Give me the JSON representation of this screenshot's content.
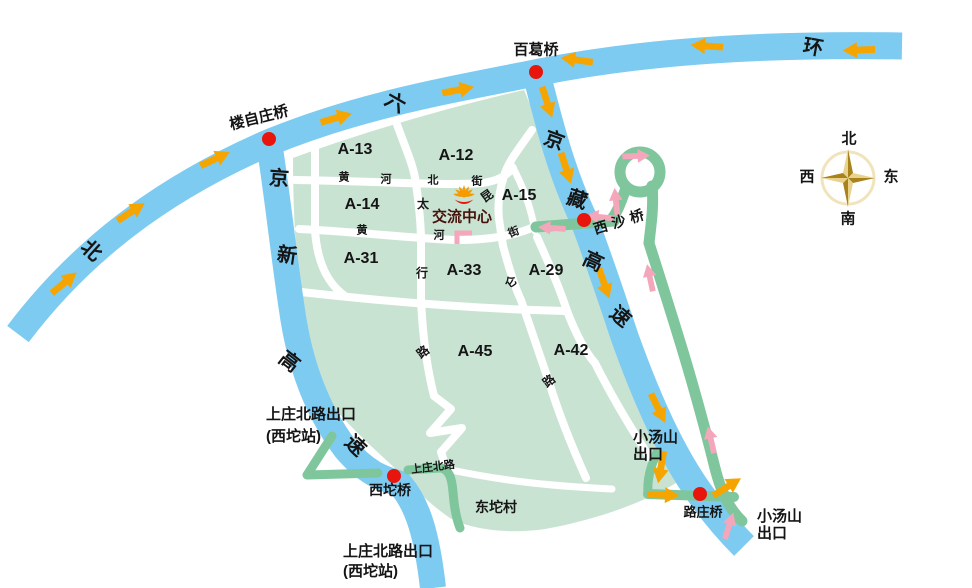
{
  "colors": {
    "road_blue": "#7ecbf2",
    "area_green": "#c9e3d3",
    "ramp_green": "#7fc69d",
    "arrow_yellow": "#f6a500",
    "arrow_pink": "#f4a6ba",
    "marker_red": "#e8150d",
    "center_text_dark_red": "#46120a",
    "compass_gold": "#c9992b"
  },
  "ring_road": {
    "chars": [
      "北",
      "六",
      "环"
    ]
  },
  "jingxin_expressway": {
    "chars": [
      "京",
      "新",
      "高",
      "速"
    ]
  },
  "jingzang_expressway": {
    "chars": [
      "京",
      "藏",
      "高",
      "速"
    ]
  },
  "bridges": {
    "louzizhuang": "楼自庄桥",
    "baige": "百葛桥",
    "xisha": "西沙桥",
    "xituo": "西坨桥",
    "luzhuang": "路庄桥"
  },
  "exits": {
    "shangzhuang_line1": "上庄北路出口",
    "shangzhuang_line2": "(西坨站)",
    "xiaotangshan_line1": "小汤山",
    "xiaotangshan_line2": "出口"
  },
  "areas": {
    "a13": "A-13",
    "a12": "A-12",
    "a14": "A-14",
    "a15": "A-15",
    "a31": "A-31",
    "a33": "A-33",
    "a29": "A-29",
    "a45": "A-45",
    "a42": "A-42"
  },
  "streets": {
    "huanghe_north": [
      "黄",
      "河",
      "北",
      "街"
    ],
    "huanghe": [
      "黄",
      "河",
      "街"
    ],
    "taihang": [
      "太",
      "行",
      "路"
    ],
    "kunlun": [
      "昆",
      "仑",
      "路"
    ],
    "shangzhuang_north_road": "上庄北路"
  },
  "village": "东坨村",
  "center_name": "交流中心",
  "compass": {
    "n": "北",
    "s": "南",
    "w": "西",
    "e": "东"
  }
}
